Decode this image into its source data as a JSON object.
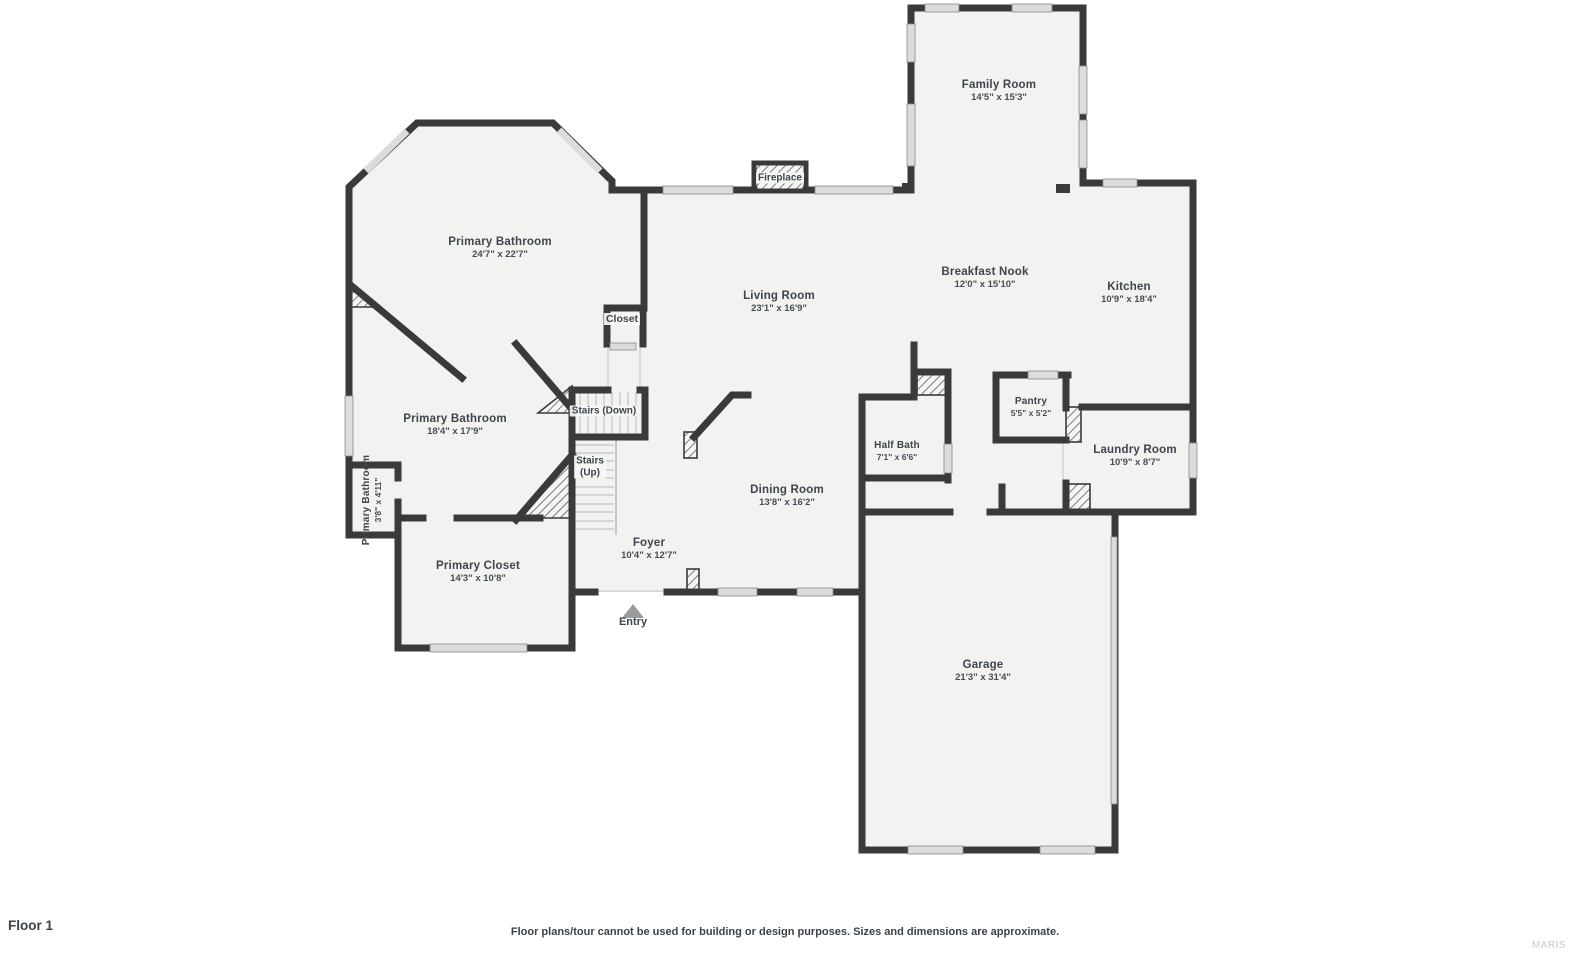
{
  "page": {
    "floor_label": "Floor 1",
    "disclaimer": "Floor plans/tour cannot be used for building or design purposes. Sizes and dimensions are approximate.",
    "watermark": "MARIS"
  },
  "colors": {
    "wall": "#3a3a3a",
    "room_fill": "#f2f2f1",
    "window_fill": "#dcdcdc",
    "label_text": "#3e454c",
    "entry_marker": "#9b9b9b",
    "watermark_text": "#c9c9c9"
  },
  "rooms": [
    {
      "name": "Family Room",
      "dims": "14'5\" x 15'3\""
    },
    {
      "name": "Primary Bathroom",
      "dims": "24'7\" x 22'7\""
    },
    {
      "name": "Living Room",
      "dims": "23'1\" x 16'9\""
    },
    {
      "name": "Breakfast Nook",
      "dims": "12'0\" x 15'10\""
    },
    {
      "name": "Kitchen",
      "dims": "10'9\" x 18'4\""
    },
    {
      "name": "Primary Bathroom",
      "dims": "18'4\" x 17'9\""
    },
    {
      "name": "Pantry",
      "dims": "5'5\" x 5'2\""
    },
    {
      "name": "Half Bath",
      "dims": "7'1\" x 6'6\""
    },
    {
      "name": "Laundry Room",
      "dims": "10'9\" x 8'7\""
    },
    {
      "name": "Dining Room",
      "dims": "13'8\" x 16'2\""
    },
    {
      "name": "Foyer",
      "dims": "10'4\" x 12'7\""
    },
    {
      "name": "Primary Closet",
      "dims": "14'3\" x 10'8\""
    },
    {
      "name": "Garage",
      "dims": "21'3\" x 31'4\""
    },
    {
      "name": "Primary Bathroom",
      "dims": "3'8\" x 4'11\""
    }
  ],
  "features": {
    "fireplace": "Fireplace",
    "closet": "Closet",
    "stairs_down": "Stairs (Down)",
    "stairs_up_line1": "Stairs",
    "stairs_up_line2": "(Up)",
    "entry": "Entry"
  }
}
